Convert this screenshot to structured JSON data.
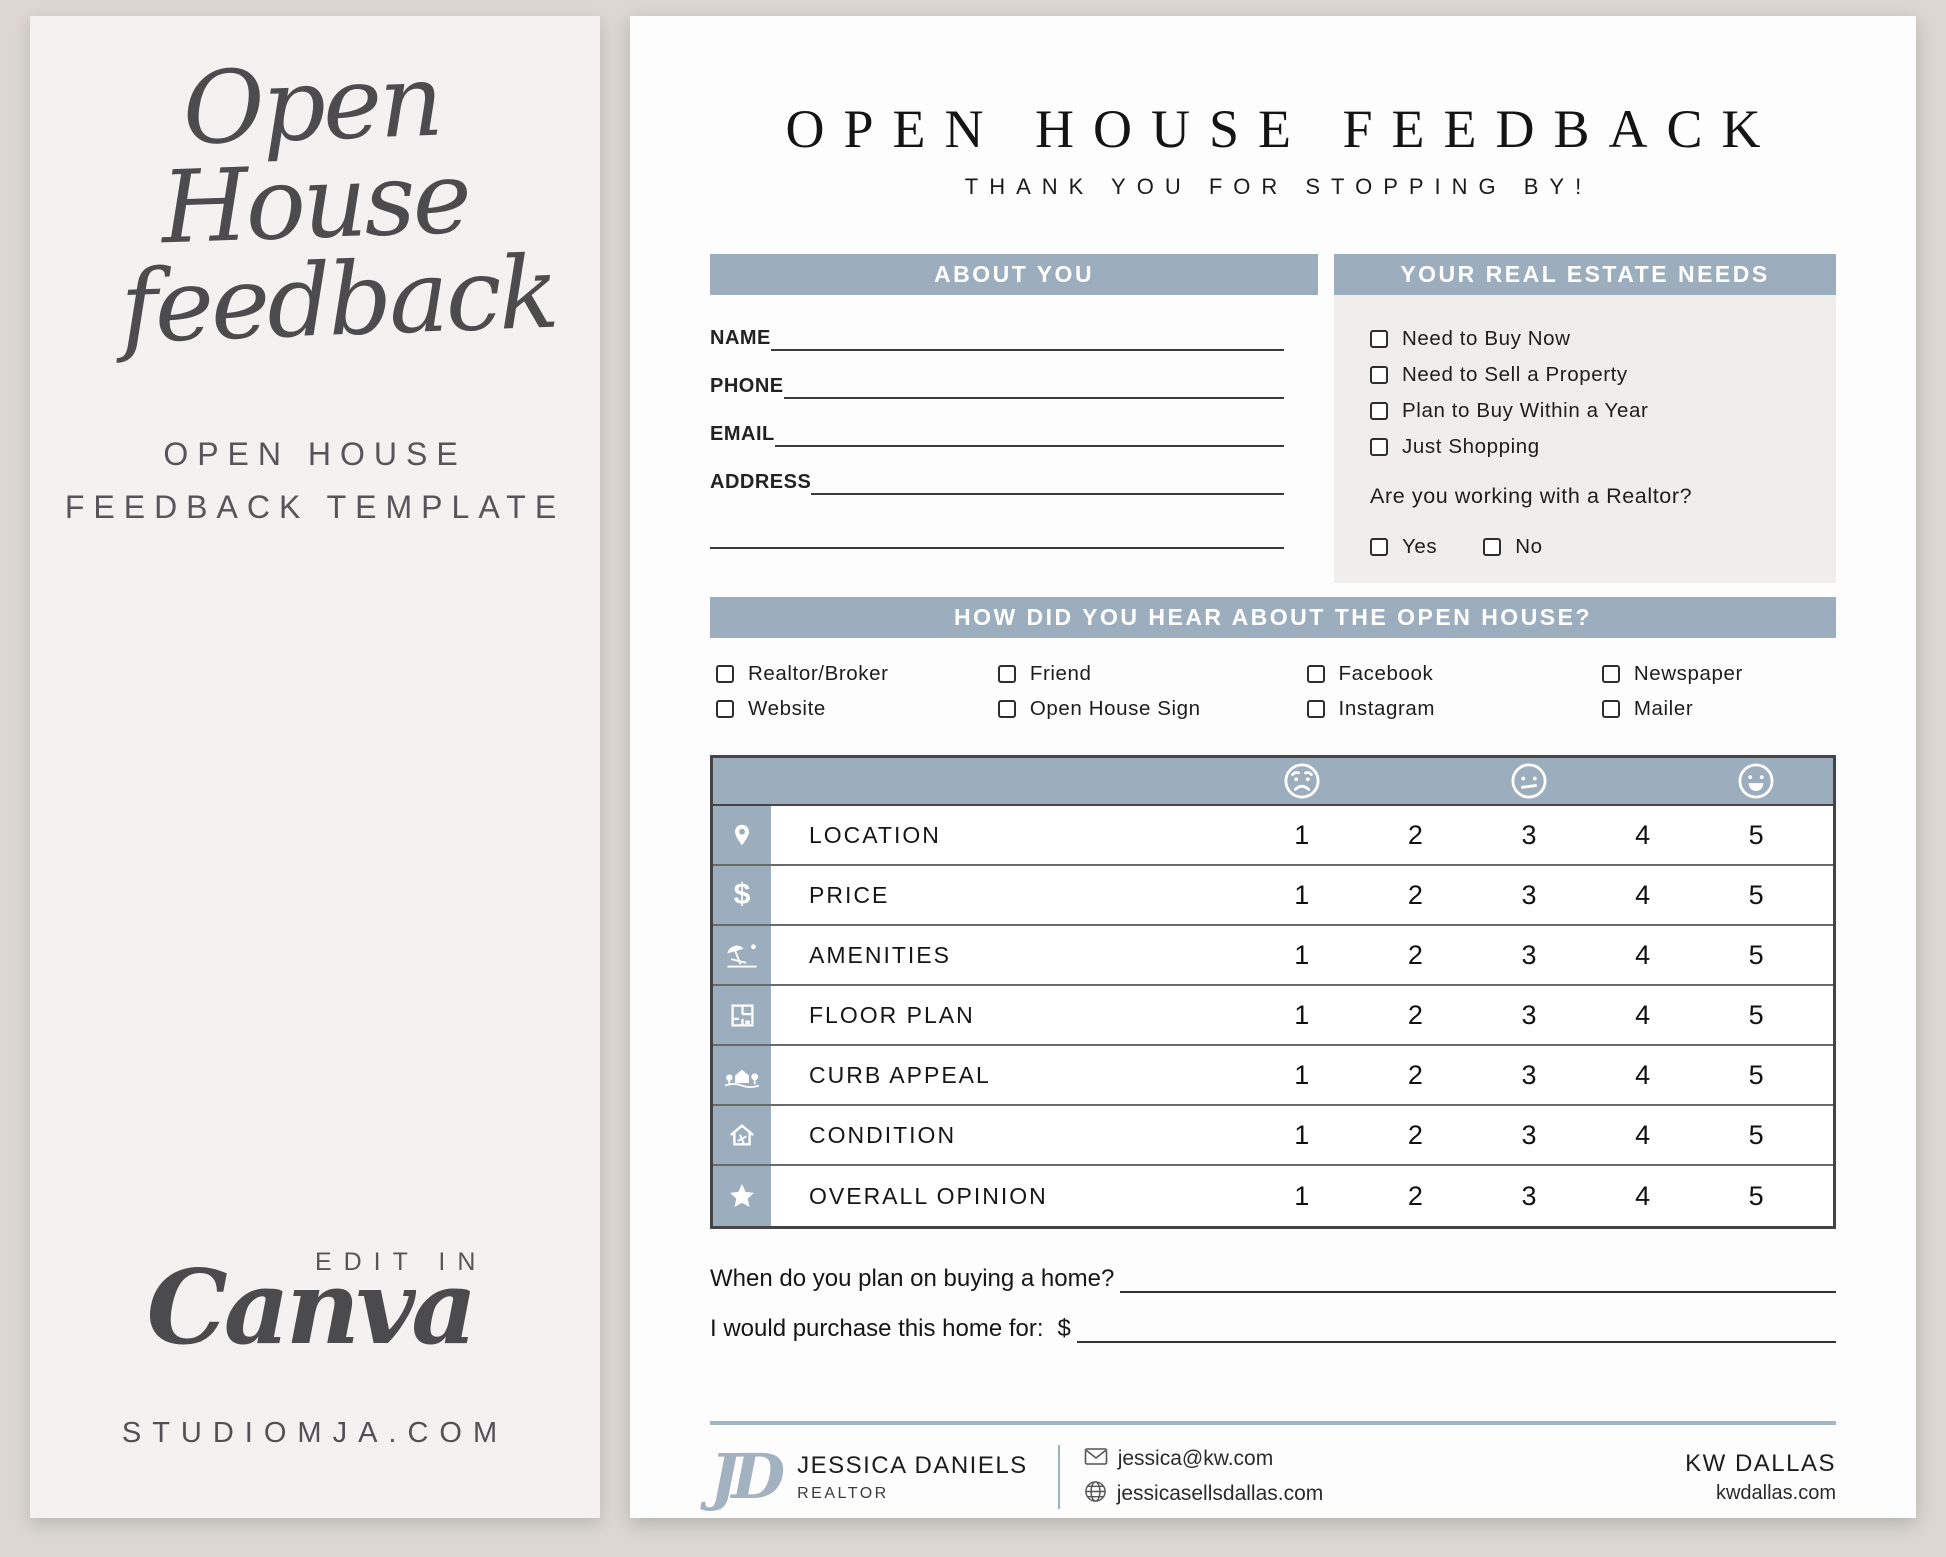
{
  "colors": {
    "accent": "#9caebd",
    "needs_panel": "#efeeec",
    "page_bg": "#dcd7d3"
  },
  "left_panel": {
    "script_line1": "Open House",
    "script_line2": "feedback",
    "caption_line1": "OPEN HOUSE",
    "caption_line2": "FEEDBACK TEMPLATE",
    "edit_in": "EDIT IN",
    "canva_wordmark": "Canva",
    "site": "STUDIOMJA.COM"
  },
  "form": {
    "title": "OPEN HOUSE FEEDBACK",
    "subtitle": "THANK YOU FOR STOPPING BY!",
    "about": {
      "header": "ABOUT YOU",
      "fields": [
        "NAME",
        "PHONE",
        "EMAIL",
        "ADDRESS"
      ]
    },
    "needs": {
      "header": "YOUR REAL ESTATE NEEDS",
      "options": [
        "Need to Buy Now",
        "Need to Sell a Property",
        "Plan to Buy Within a Year",
        "Just Shopping"
      ],
      "realtor_question": "Are you working with a Realtor?",
      "yes": "Yes",
      "no": "No"
    },
    "hear": {
      "header": "HOW DID YOU HEAR ABOUT THE OPEN HOUSE?",
      "options": [
        [
          "Realtor/Broker",
          "Website"
        ],
        [
          "Friend",
          "Open House Sign"
        ],
        [
          "Facebook",
          "Instagram"
        ],
        [
          "Newspaper",
          "Mailer"
        ]
      ]
    },
    "rating": {
      "dollar_glyph": "$",
      "scale": [
        "1",
        "2",
        "3",
        "4",
        "5"
      ],
      "rows": [
        {
          "icon": "location-pin-icon",
          "label": "LOCATION"
        },
        {
          "icon": "dollar-icon",
          "label": "PRICE"
        },
        {
          "icon": "beach-umbrella-icon",
          "label": "AMENITIES"
        },
        {
          "icon": "floor-plan-icon",
          "label": "FLOOR PLAN"
        },
        {
          "icon": "house-landscape-icon",
          "label": "CURB APPEAL"
        },
        {
          "icon": "house-tools-icon",
          "label": "CONDITION"
        },
        {
          "icon": "star-icon",
          "label": "OVERALL OPINION"
        }
      ]
    },
    "questions": {
      "q1": "When do you plan on buying a home?",
      "q2": "I would purchase this home for:",
      "currency": "$"
    },
    "footer": {
      "monogram": "JD",
      "name": "JESSICA DANIELS",
      "role": "REALTOR",
      "email": "jessica@kw.com",
      "website": "jessicasellsdallas.com",
      "office": "KW DALLAS",
      "office_site": "kwdallas.com"
    }
  }
}
